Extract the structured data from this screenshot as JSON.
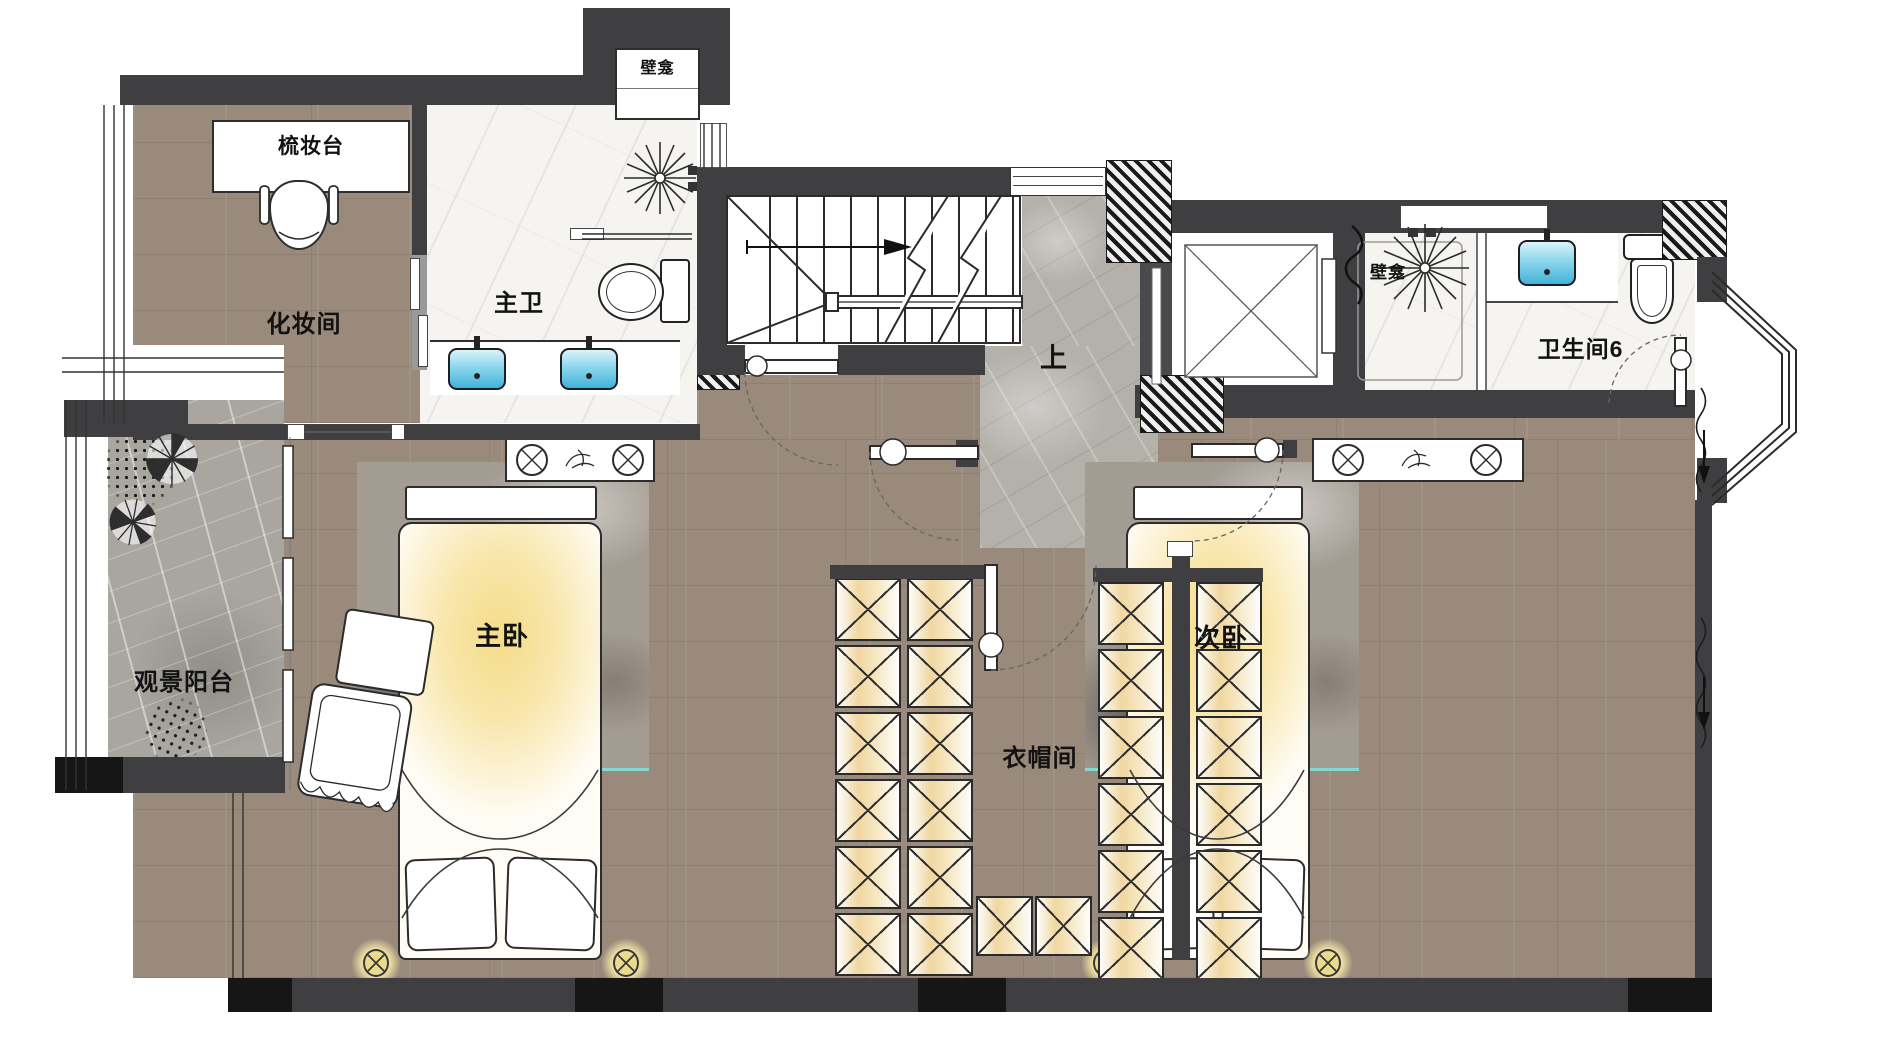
{
  "rooms": {
    "makeup_room": {
      "label": "化妆间"
    },
    "master_bath": {
      "label": "主卫"
    },
    "view_balcony": {
      "label": "观景阳台"
    },
    "master_bedroom": {
      "label": "主卧"
    },
    "closet": {
      "label": "衣帽间"
    },
    "second_bedroom": {
      "label": "次卧"
    },
    "bathroom6": {
      "label": "卫生间6"
    }
  },
  "annotations": {
    "dresser": {
      "label": "梳妆台"
    },
    "niche_top": {
      "label": "壁龛"
    },
    "niche_shower": {
      "label": "壁龛"
    },
    "stairs_up": {
      "label": "上"
    }
  },
  "icons": {
    "stairs_direction": "arrow-right",
    "elevator": "crossed-box-icon",
    "shower_head": "starburst-icon",
    "downlight": "circle-cross-icon"
  },
  "colors": {
    "wall": "#3f3f41",
    "wall_black": "#161616",
    "wood_floor": "#998a7c",
    "stone_floor": "#b4b1ab",
    "marble_floor": "#f5f4f1",
    "wardrobe_glow": "#f0d7a0",
    "bed_glow": "#f5dc89",
    "sink_blue": "#41b3d9",
    "rug_accent": "#86d6d2"
  }
}
